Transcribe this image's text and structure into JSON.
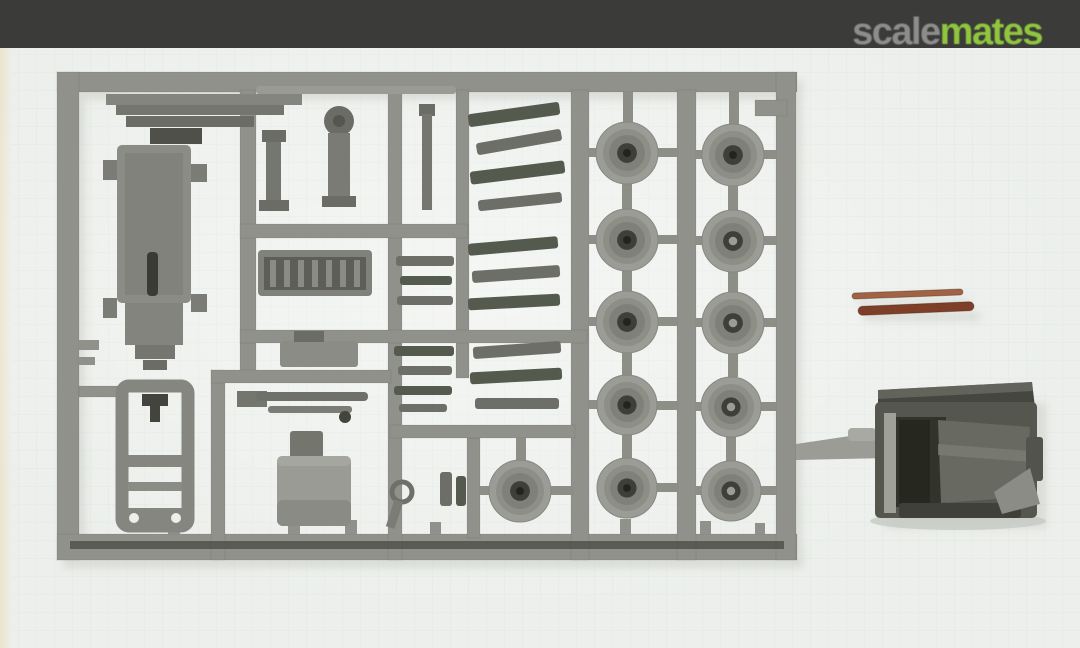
{
  "header": {
    "logo_scale": "scale",
    "logo_mates": "mates"
  },
  "colors": {
    "header_bar": "#3b3b39",
    "logo_scale": "#8d8d8d",
    "logo_mates": "#90c63e",
    "photo_bg": "#ecefeb",
    "grid_line": "#b8ccc6",
    "mat_edge": "#ece3cc",
    "sprue": "#90918a",
    "sprue_dark": "#7b7c75",
    "part_mid": "#6d6e67",
    "part_dark": "#56574f",
    "part_darkest": "#3a3b35",
    "part_light": "#9a9b94",
    "olive": "#555a4e",
    "wheel_outer": "#9b9c95",
    "wheel_mid": "#8d8e86",
    "wheel_face": "#7f807a",
    "hub_dark": "#3e3f38",
    "hub_dot": "#23241f",
    "rod_light": "#a06444",
    "rod_dark": "#7e3f28",
    "cab_body": "#55564e",
    "cab_dark": "#26271f",
    "cab_face": "#686960",
    "cab_face_hi": "#7b7c74",
    "shadow": "#c7cac4"
  },
  "photo": {
    "caption": "Grey injection-moulded sprue with truck chassis parts and road wheels, two copper rods and a dark grey cab casting on a pale cutting mat",
    "sprue": {
      "runners": [
        [
          57,
          72,
          740,
          20
        ],
        [
          57,
          72,
          22,
          488
        ],
        [
          57,
          534,
          740,
          26
        ],
        [
          776,
          72,
          20,
          488
        ],
        [
          240,
          90,
          16,
          282
        ],
        [
          388,
          90,
          14,
          470
        ],
        [
          456,
          90,
          13,
          288
        ],
        [
          571,
          90,
          18,
          470
        ],
        [
          677,
          90,
          19,
          470
        ],
        [
          211,
          370,
          14,
          190
        ],
        [
          467,
          438,
          13,
          100
        ],
        [
          240,
          224,
          228,
          14
        ],
        [
          240,
          330,
          347,
          13
        ],
        [
          79,
          386,
          45,
          11
        ],
        [
          211,
          370,
          180,
          13
        ],
        [
          390,
          425,
          185,
          13
        ],
        [
          755,
          100,
          32,
          16
        ]
      ],
      "stubs": [
        [
          79,
          340,
          20,
          10
        ],
        [
          79,
          357,
          16,
          8
        ],
        [
          168,
          514,
          12,
          20
        ],
        [
          288,
          522,
          12,
          12
        ],
        [
          345,
          520,
          12,
          14
        ],
        [
          430,
          522,
          11,
          12
        ],
        [
          620,
          519,
          11,
          15
        ],
        [
          700,
          521,
          11,
          13
        ],
        [
          755,
          523,
          10,
          11
        ]
      ],
      "gates": [
        [
          589,
          148,
          16,
          9
        ],
        [
          651,
          148,
          28,
          9
        ],
        [
          695,
          150,
          20,
          9
        ],
        [
          759,
          150,
          17,
          9
        ],
        [
          589,
          235,
          16,
          9
        ],
        [
          651,
          235,
          28,
          9
        ],
        [
          695,
          236,
          20,
          9
        ],
        [
          759,
          236,
          17,
          9
        ],
        [
          589,
          317,
          16,
          9
        ],
        [
          651,
          317,
          28,
          9
        ],
        [
          695,
          318,
          20,
          9
        ],
        [
          759,
          318,
          17,
          9
        ],
        [
          589,
          400,
          16,
          9
        ],
        [
          651,
          401,
          28,
          9
        ],
        [
          695,
          402,
          20,
          9
        ],
        [
          757,
          402,
          19,
          9
        ],
        [
          480,
          486,
          14,
          9
        ],
        [
          548,
          486,
          26,
          9
        ],
        [
          651,
          483,
          28,
          9
        ],
        [
          695,
          486,
          20,
          9
        ],
        [
          757,
          486,
          19,
          9
        ],
        [
          623,
          92,
          10,
          31
        ],
        [
          729,
          92,
          10,
          34
        ],
        [
          622,
          184,
          10,
          26
        ],
        [
          728,
          186,
          10,
          24
        ],
        [
          622,
          271,
          10,
          21
        ],
        [
          728,
          272,
          10,
          21
        ],
        [
          622,
          353,
          10,
          22
        ],
        [
          728,
          354,
          10,
          23
        ],
        [
          622,
          435,
          10,
          23
        ],
        [
          726,
          437,
          10,
          25
        ],
        [
          516,
          438,
          10,
          24
        ]
      ],
      "wheels": [
        [
          627,
          153,
          31,
          0
        ],
        [
          733,
          155,
          31,
          0
        ],
        [
          627,
          240,
          31,
          0
        ],
        [
          733,
          241,
          31,
          1
        ],
        [
          627,
          322,
          31,
          0
        ],
        [
          733,
          323,
          31,
          1
        ],
        [
          627,
          405,
          30,
          0
        ],
        [
          731,
          407,
          30,
          1
        ],
        [
          520,
          491,
          31,
          0
        ],
        [
          627,
          488,
          30,
          0
        ],
        [
          731,
          491,
          30,
          1
        ]
      ],
      "small_parts": [
        [
          256,
          86,
          200,
          8,
          0,
          2
        ],
        [
          468,
          108,
          92,
          13,
          -8,
          1
        ],
        [
          476,
          136,
          86,
          12,
          -10,
          0
        ],
        [
          470,
          166,
          95,
          13,
          -7,
          1
        ],
        [
          478,
          196,
          84,
          11,
          -6,
          0
        ],
        [
          468,
          240,
          90,
          12,
          -5,
          1
        ],
        [
          472,
          268,
          88,
          12,
          -4,
          0
        ],
        [
          468,
          296,
          92,
          12,
          -3,
          1
        ],
        [
          396,
          256,
          58,
          10,
          0,
          0
        ],
        [
          400,
          276,
          52,
          9,
          0,
          1
        ],
        [
          397,
          296,
          56,
          9,
          0,
          0
        ],
        [
          394,
          346,
          60,
          10,
          0,
          1
        ],
        [
          398,
          366,
          54,
          9,
          0,
          0
        ],
        [
          394,
          386,
          58,
          9,
          0,
          1
        ],
        [
          399,
          404,
          48,
          8,
          0,
          0
        ],
        [
          473,
          344,
          88,
          12,
          -4,
          0
        ],
        [
          470,
          370,
          92,
          12,
          -3,
          1
        ],
        [
          475,
          398,
          84,
          11,
          0,
          0
        ],
        [
          440,
          472,
          12,
          34,
          0,
          0
        ],
        [
          456,
          476,
          10,
          30,
          0,
          1
        ]
      ],
      "rods": [
        {
          "x": 852,
          "y": 291,
          "w": 111,
          "h": 6,
          "rot": -2.2,
          "fill": "rod-light"
        },
        {
          "x": 858,
          "y": 304,
          "w": 116,
          "h": 9,
          "rot": -2.4,
          "fill": "rod-dark"
        }
      ]
    }
  }
}
